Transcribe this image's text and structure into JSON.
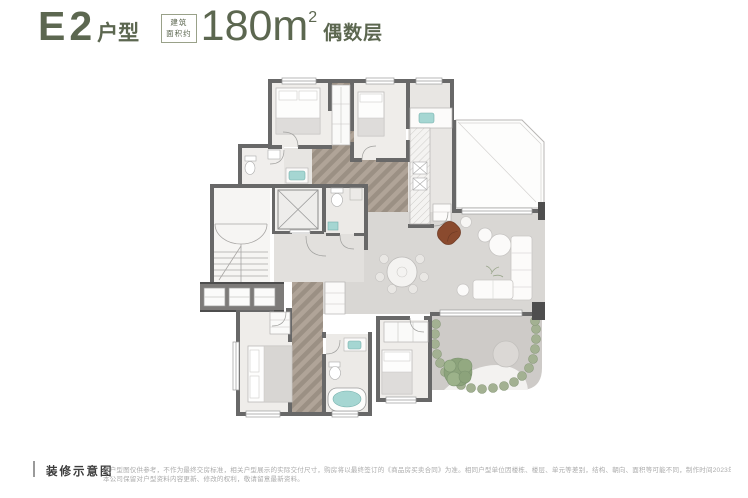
{
  "header": {
    "title_main": "E2",
    "title_suffix": "户型",
    "area_box": {
      "line1": "建筑",
      "line2": "面积约"
    },
    "area_value": "180m",
    "area_sup": "2",
    "floor_label": "偶数层"
  },
  "footer": {
    "label": "装修示意图",
    "disclaimer_line1": "本户型图仅供参考，不作为最终交房标准，相关户型展示的实际交付尺寸，购房将以最终签订的《商品房买卖合同》为准。相同户型单位因楼栋、楼层、单元等差别，结构、朝向、面积等可能不同，制作时间2023年5月。",
    "disclaimer_line2": "本公司保留对户型资料内容更新、修改的权利，敬请留意最新资料。"
  },
  "colors": {
    "title": "#5c6750",
    "wall": "#686868",
    "wall_dark": "#4e4e4e",
    "wood": "#b0a498",
    "wood_dark": "#9b9084",
    "floor_light": "#efedea",
    "floor_living": "#d9d7d4",
    "teal": "#a5d6d2",
    "accent_chair": "#8a4a2e",
    "plant": "#a3b192",
    "tree": "#8ca37b",
    "paving": "#cecbc8"
  }
}
